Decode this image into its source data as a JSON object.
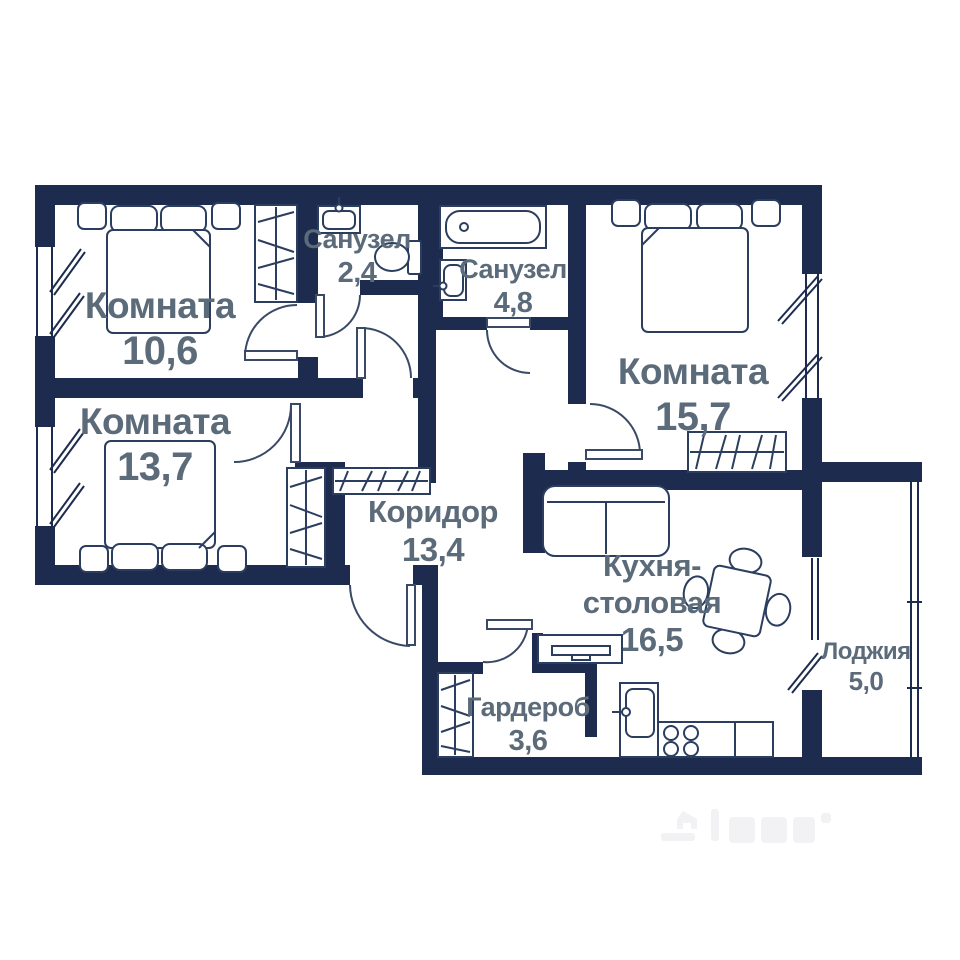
{
  "plan": {
    "title": "apartment-floor-plan",
    "wall_color": "#1d2c4e",
    "furniture_line_color": "#2c3e5f",
    "label_color": "#5c6b7a",
    "background": "#ffffff",
    "rooms": [
      {
        "name": "Комната",
        "area": "10,6"
      },
      {
        "name": "Комната",
        "area": "13,7"
      },
      {
        "name": "Санузел",
        "area": "2,4"
      },
      {
        "name": "Санузел",
        "area": "4,8"
      },
      {
        "name": "Комната",
        "area": "15,7"
      },
      {
        "name": "Коридор",
        "area": "13,4"
      },
      {
        "name": "Кухня-столовая",
        "area": "16,5"
      },
      {
        "name": "Гардероб",
        "area": "3,6"
      },
      {
        "name": "Лоджия",
        "area": "5,0"
      }
    ],
    "watermark": {
      "name": "faint-logo-watermark"
    }
  }
}
